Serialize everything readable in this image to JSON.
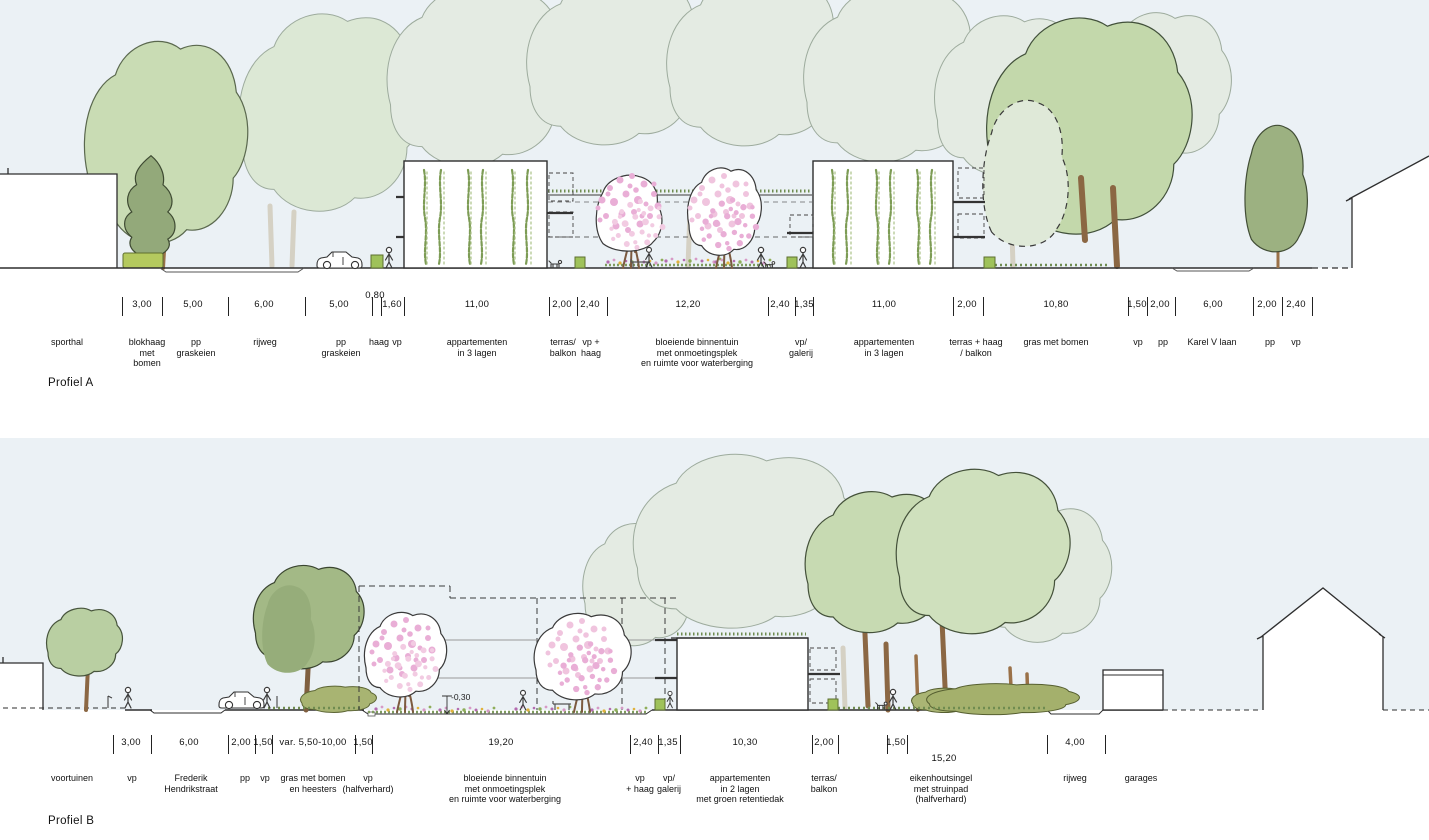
{
  "colors": {
    "sky": "#ebf1f5",
    "foliage_pale": "#e4ebe3",
    "foliage_light": "#c9dcb4",
    "foliage_dark": "#93a97a",
    "blossom_pink": "#e9aed6",
    "hedge_green": "#b4c95e",
    "trunk_brown": "#8b6743",
    "line": "#2e2e2e"
  },
  "profiles": [
    {
      "name": "Profiel A",
      "ticks": [
        122,
        162,
        228,
        305,
        372,
        381,
        404,
        549,
        577,
        607,
        768,
        795,
        813,
        953,
        983,
        1128,
        1147,
        1175,
        1253,
        1282,
        1312
      ],
      "dims": [
        {
          "v": "3,00",
          "x": 142
        },
        {
          "v": "5,00",
          "x": 193
        },
        {
          "v": "6,00",
          "x": 264
        },
        {
          "v": "5,00",
          "x": 339
        },
        {
          "v": "0,80",
          "x": 375,
          "dy": -9
        },
        {
          "v": "1,60",
          "x": 392
        },
        {
          "v": "11,00",
          "x": 477
        },
        {
          "v": "2,00",
          "x": 562
        },
        {
          "v": "2,40",
          "x": 590
        },
        {
          "v": "12,20",
          "x": 688
        },
        {
          "v": "2,40",
          "x": 780
        },
        {
          "v": "1,35",
          "x": 804
        },
        {
          "v": "11,00",
          "x": 884
        },
        {
          "v": "2,00",
          "x": 967
        },
        {
          "v": "10,80",
          "x": 1056
        },
        {
          "v": "1,50",
          "x": 1137
        },
        {
          "v": "2,00",
          "x": 1160
        },
        {
          "v": "6,00",
          "x": 1213
        },
        {
          "v": "2,00",
          "x": 1267
        },
        {
          "v": "2,40",
          "x": 1296
        }
      ],
      "zones": [
        {
          "label": "sporthal",
          "x": 67
        },
        {
          "label": "blokhaag\nmet\nbomen",
          "x": 147
        },
        {
          "label": "pp\ngraskeien",
          "x": 196
        },
        {
          "label": "rijweg",
          "x": 265
        },
        {
          "label": "pp\ngraskeien",
          "x": 341
        },
        {
          "label": "haag",
          "x": 379
        },
        {
          "label": "vp",
          "x": 397
        },
        {
          "label": "appartementen\nin 3 lagen",
          "x": 477
        },
        {
          "label": "terras/\nbalkon",
          "x": 563
        },
        {
          "label": "vp +\nhaag",
          "x": 591
        },
        {
          "label": "bloeiende binnentuin\nmet onmoetingsplek\nen ruimte voor waterberging",
          "x": 697
        },
        {
          "label": "vp/\ngalerij",
          "x": 801
        },
        {
          "label": "appartementen\nin 3 lagen",
          "x": 884
        },
        {
          "label": "terras + haag\n/ balkon",
          "x": 976
        },
        {
          "label": "gras met bomen",
          "x": 1056
        },
        {
          "label": "vp",
          "x": 1138
        },
        {
          "label": "pp",
          "x": 1163
        },
        {
          "label": "Karel V laan",
          "x": 1212
        },
        {
          "label": "pp",
          "x": 1270
        },
        {
          "label": "vp",
          "x": 1296
        }
      ],
      "annotations": []
    },
    {
      "name": "Profiel B",
      "ticks": [
        113,
        151,
        228,
        255,
        272,
        355,
        372,
        630,
        658,
        680,
        812,
        838,
        887,
        907,
        1047,
        1105
      ],
      "dims": [
        {
          "v": "3,00",
          "x": 131
        },
        {
          "v": "6,00",
          "x": 189
        },
        {
          "v": "2,00",
          "x": 241
        },
        {
          "v": "1,50",
          "x": 263
        },
        {
          "v": "var. 5,50-10,00",
          "x": 313
        },
        {
          "v": "1,50",
          "x": 363
        },
        {
          "v": "19,20",
          "x": 501
        },
        {
          "v": "2,40",
          "x": 643
        },
        {
          "v": "1,35",
          "x": 668
        },
        {
          "v": "10,30",
          "x": 745
        },
        {
          "v": "2,00",
          "x": 824
        },
        {
          "v": "1,50",
          "x": 896
        },
        {
          "v": "15,20",
          "x": 944,
          "dy": 16
        },
        {
          "v": "4,00",
          "x": 1075
        }
      ],
      "zones": [
        {
          "label": "voortuinen",
          "x": 72
        },
        {
          "label": "vp",
          "x": 132
        },
        {
          "label": "Frederik\nHendrikstraat",
          "x": 191
        },
        {
          "label": "pp",
          "x": 245
        },
        {
          "label": "vp",
          "x": 265
        },
        {
          "label": "gras met bomen\nen heesters",
          "x": 313
        },
        {
          "label": "vp\n(halfverhard)",
          "x": 368
        },
        {
          "label": "bloeiende binnentuin\nmet onmoetingsplek\nen ruimte voor waterberging",
          "x": 505
        },
        {
          "label": "vp\n+ haag",
          "x": 640
        },
        {
          "label": "vp/\ngalerij",
          "x": 669
        },
        {
          "label": "appartementen\nin 2 lagen\nmet groen retentiedak",
          "x": 740
        },
        {
          "label": "terras/\nbalkon",
          "x": 824
        },
        {
          "label": "eikenhoutsingel\nmet struinpad\n(halfverhard)",
          "x": 941
        },
        {
          "label": "rijweg",
          "x": 1075
        },
        {
          "label": "garages",
          "x": 1141
        }
      ],
      "annotations": [
        {
          "label": "-0,30",
          "x": 451,
          "y": 692
        }
      ]
    }
  ]
}
